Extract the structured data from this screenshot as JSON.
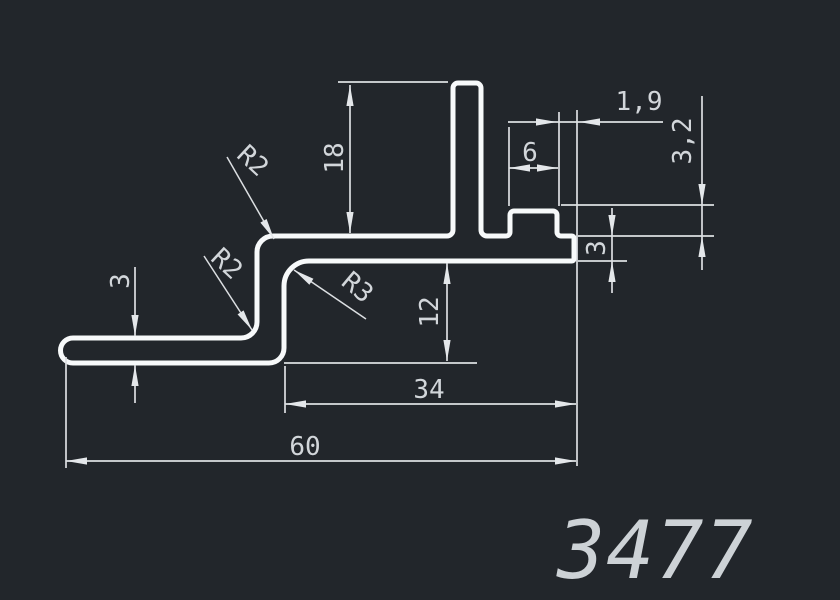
{
  "part_label": {
    "number": "3477"
  },
  "dimensions": {
    "fin_height": "18",
    "bump_width": "6",
    "lip_overhang": "1,9",
    "bump_height": "3,2",
    "lip_thickness": "3",
    "web_depth": "12",
    "leg_thickness": "3",
    "flange_length": "34",
    "overall_length": "60"
  },
  "radii": {
    "top_outer": "R2",
    "bottom_inner": "R2",
    "web_inner": "R3"
  },
  "colors": {
    "background": "#22262b",
    "profile_line": "#f7f9fa",
    "dimension_line": "#dcdfe2",
    "dimension_text": "#d2d6da",
    "part_number_text": "#cdd2d6"
  }
}
